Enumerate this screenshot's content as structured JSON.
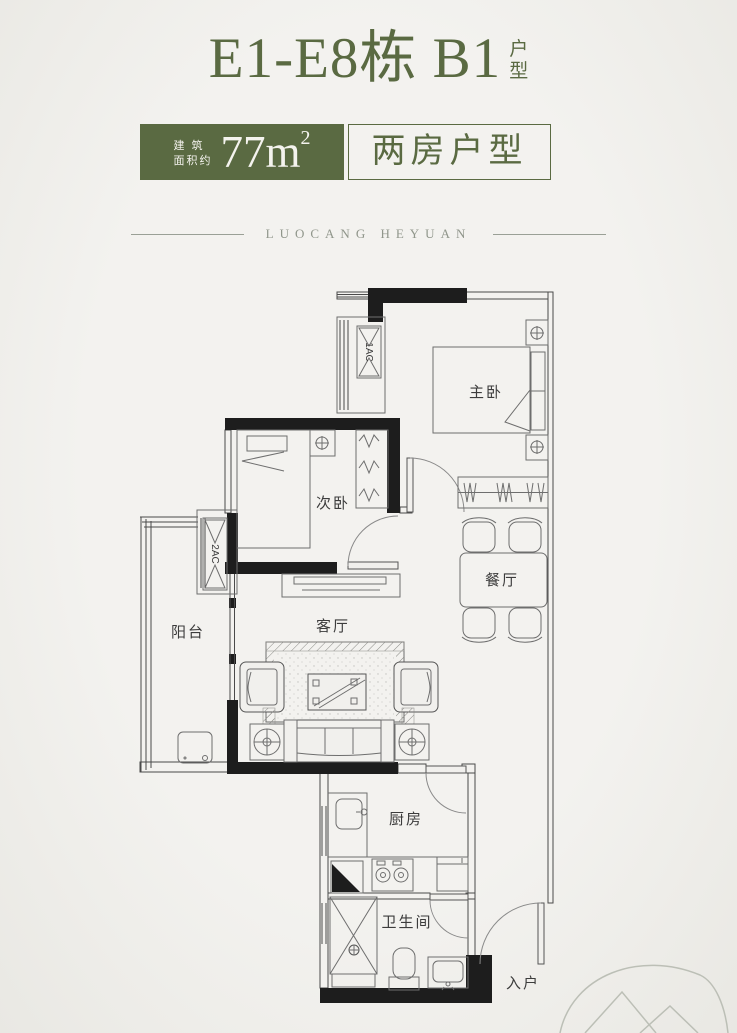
{
  "header": {
    "title": {
      "main": "E1-E8栋 B1",
      "suffix_top": "户",
      "suffix_bottom": "型"
    },
    "area_badge": {
      "label_line1": "建 筑",
      "label_line2": "面积约",
      "value": "77m",
      "sup": "2"
    },
    "type_badge": {
      "label": "两房户型"
    },
    "brand": "LUOCANG HEYUAN"
  },
  "floorplan": {
    "rooms": {
      "master_bedroom": "主卧",
      "second_bedroom": "次卧",
      "dining_room": "餐厅",
      "living_room": "客厅",
      "balcony": "阳台",
      "kitchen": "厨房",
      "bathroom": "卫生间",
      "entrance": "入户"
    },
    "equipment": {
      "ac1": "1AC",
      "ac2": "2AC"
    }
  },
  "colors": {
    "accent_green": "#5a6a42",
    "brand_text": "#90968b",
    "background": "#f1f0ed",
    "wall_black": "#1d1d1d"
  }
}
